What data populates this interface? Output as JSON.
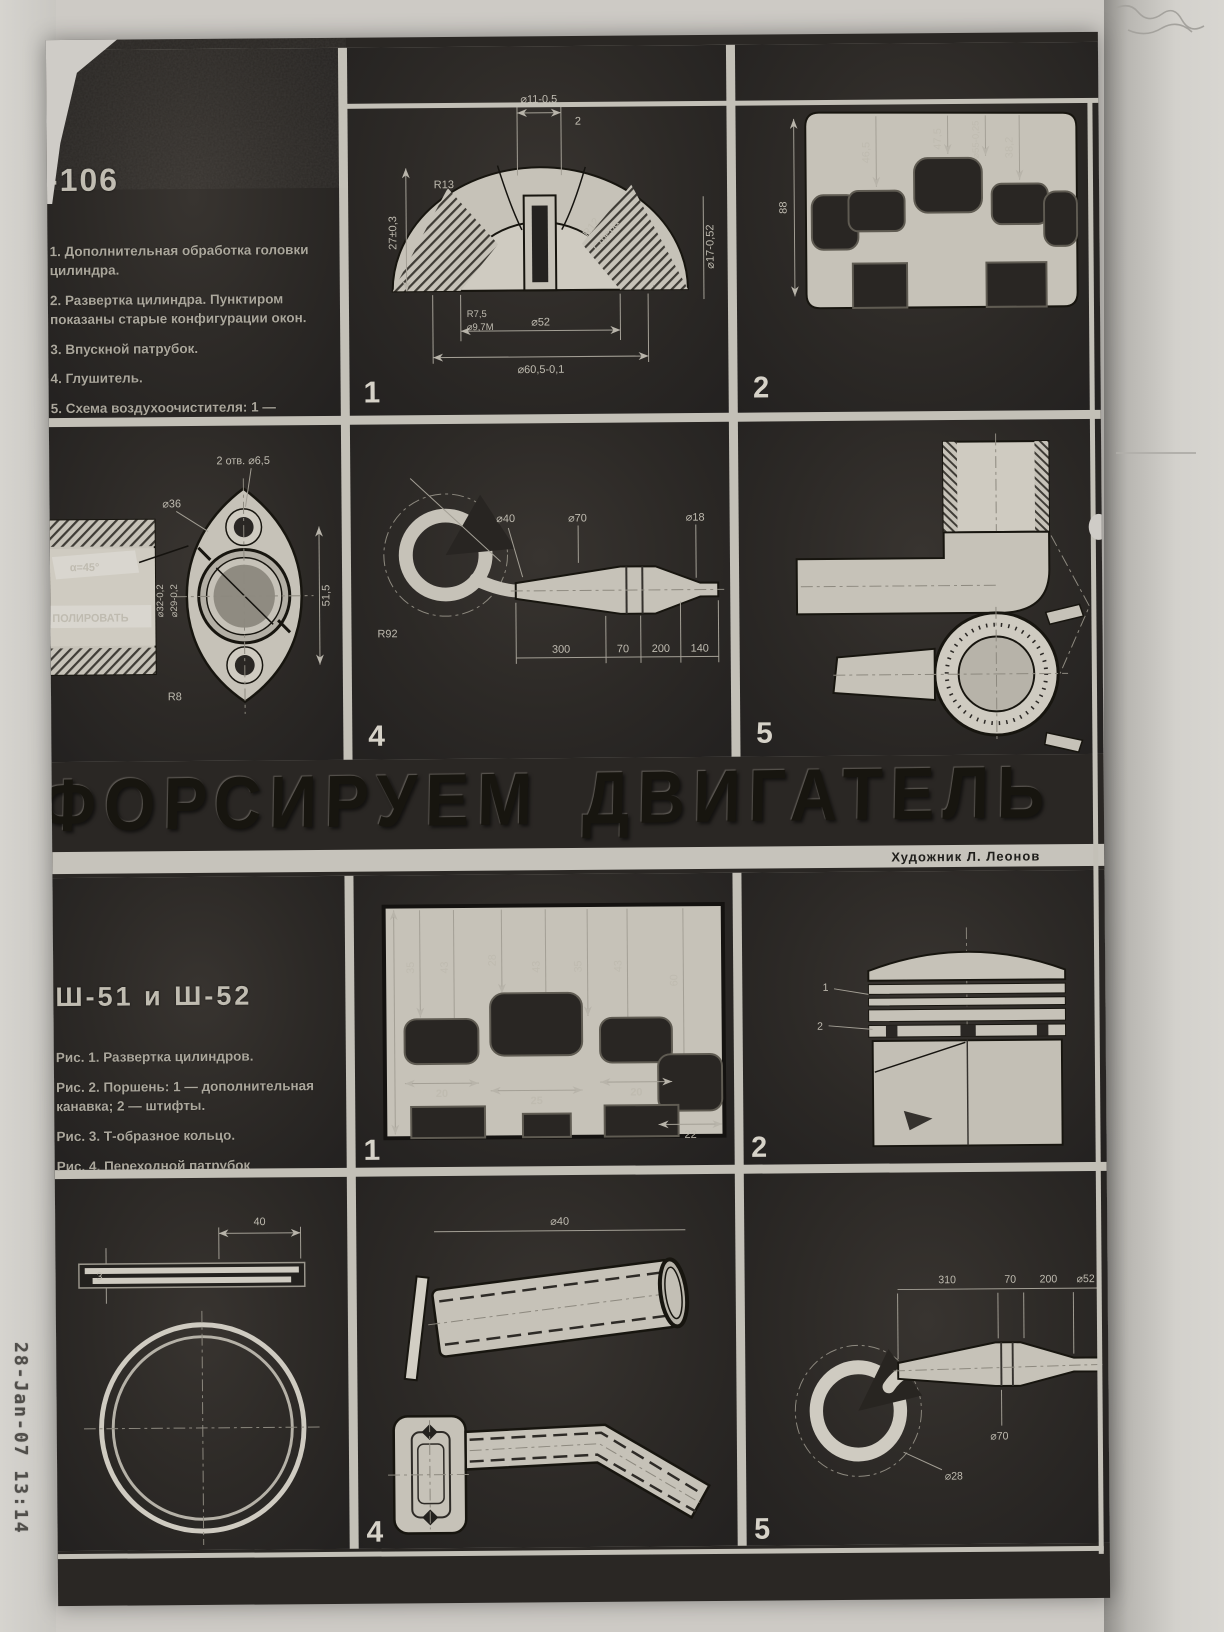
{
  "scan": {
    "timestamp": "28-Jan-07 13:14"
  },
  "masthead": {
    "title": "ФОРСИРУЕМ ДВИГАТЕЛЬ",
    "credit": "Художник Л. Леонов"
  },
  "top_section": {
    "heading": "-106",
    "captions": [
      "1. Дополнительная обработка головки цилиндра.",
      "2. Развертка цилиндра. Пунктиром показаны старые конфигурации окон.",
      "3. Впускной патрубок.",
      "4. Глушитель.",
      "5. Схема воздухоочистителя: 1 — фильтрующий элемент; 2 — заборники воздуха."
    ],
    "fig1": {
      "number": "1",
      "dim_top": "⌀11-0,5",
      "dim_top_r": "2",
      "dim_left": "27±0,3",
      "dim_r13": "R13",
      "label_sphere_1": "R12",
      "label_sphere_2": "Сфера",
      "dim_r75": "R7,5",
      "dim_m": "⌀9,7М",
      "dim_d52": "⌀52",
      "dim_d605": "⌀60,5-0,1",
      "dim_right": "⌀17-0,52"
    },
    "fig2": {
      "number": "2",
      "dim_1": "46,5",
      "dim_2": "47,5",
      "dim_3": "⌀55-0,25",
      "dim_4": "38,2",
      "dim_left": "88"
    },
    "fig3": {
      "label_angle": "α=45°",
      "label_polish": "ПОЛИРОВАТЬ",
      "dim_holes": "2 отв. ⌀6,5",
      "dim_d36": "⌀36",
      "dim_r8": "R8",
      "dim_bore1": "⌀32-0,2",
      "dim_bore2": "⌀29-0,2",
      "dim_right": "51,5"
    },
    "fig4": {
      "number": "4",
      "dim_d40": "⌀40",
      "dim_d70": "⌀70",
      "dim_d18": "⌀18",
      "dim_r": "R92",
      "dim_b1": "300",
      "dim_b2": "70",
      "dim_b3": "200",
      "dim_b4": "140"
    },
    "fig5": {
      "number": "5"
    }
  },
  "bottom_section": {
    "heading": "Ш-51  и  Ш-52",
    "captions": [
      "Рис. 1. Развертка цилиндров.",
      "Рис. 2. Поршень: 1 — дополнительная канавка; 2 — штифты.",
      "Рис. 3. Т-образное кольцо.",
      "Рис. 4. Переходной патрубок карбюратора.",
      "Рис. 5. Глушитель."
    ],
    "fig1": {
      "number": "1",
      "dims_v": [
        "35",
        "43",
        "28",
        "43",
        "35",
        "43",
        "60"
      ],
      "dims_h": [
        "20",
        "25",
        "20",
        "22"
      ]
    },
    "fig2": {
      "number": "2",
      "callout_1": "1",
      "callout_2": "2"
    },
    "fig3": {
      "dim_40": "40",
      "dim_3": "3"
    },
    "fig4": {
      "number": "4",
      "dim_top": "⌀40"
    },
    "fig5": {
      "number": "5",
      "dim_1": "310",
      "dim_2": "70",
      "dim_3": "200",
      "dim_4": "⌀52",
      "dim_d70": "⌀70",
      "dim_d28": "⌀28"
    }
  }
}
